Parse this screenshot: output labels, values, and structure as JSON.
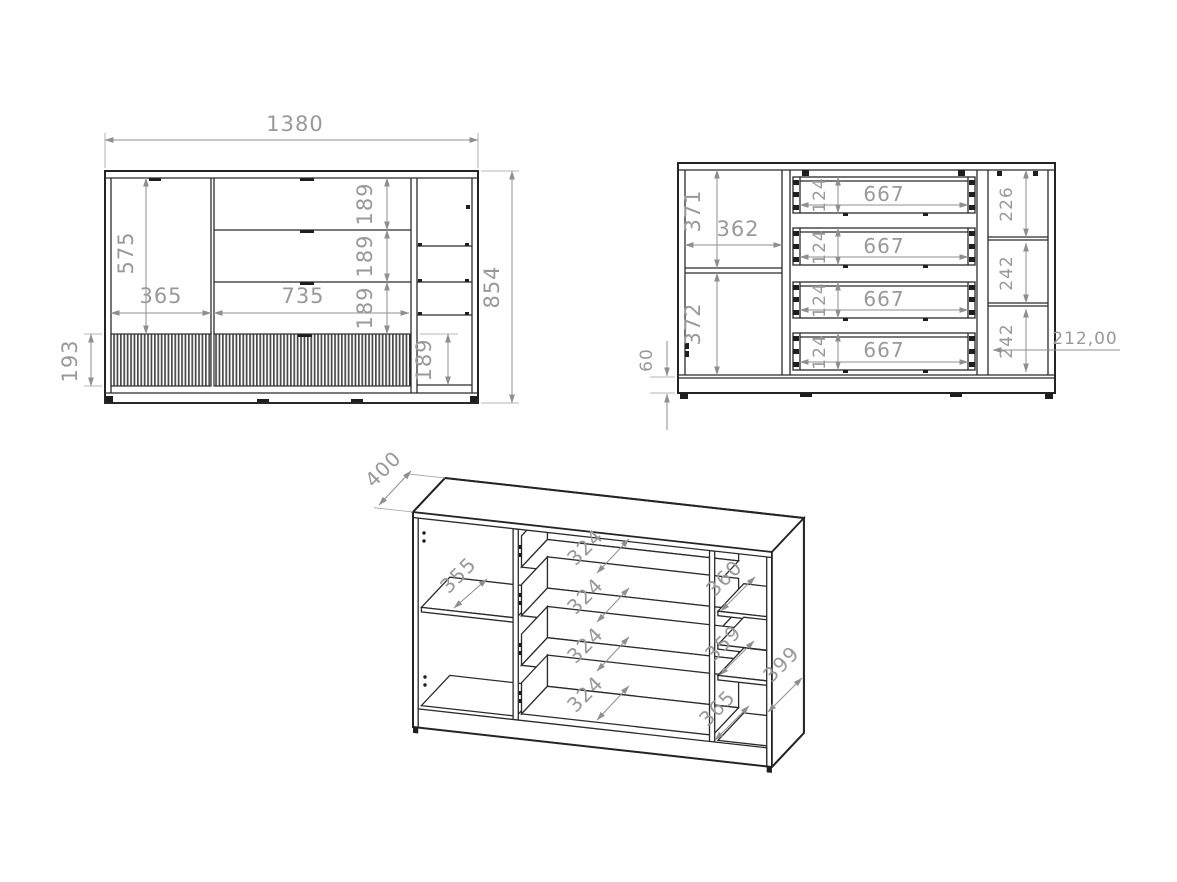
{
  "colors": {
    "outline": "#2b2b2b",
    "dimension_line": "#8f8f8f",
    "dimension_text": "#999999",
    "background": "#ffffff"
  },
  "front": {
    "width": "1380",
    "height": "854",
    "door_height": "575",
    "door_width": "365",
    "drawer_width": "735",
    "drawer_h1": "189",
    "drawer_h2": "189",
    "drawer_h3": "189",
    "niche_height": "189",
    "plinth_height": "193"
  },
  "internal": {
    "upper_height": "371",
    "inner_width": "362",
    "lower_height": "372",
    "base_height": "60",
    "drawer1": {
      "w": "667",
      "h": "124"
    },
    "drawer2": {
      "w": "667",
      "h": "124"
    },
    "drawer3": {
      "w": "667",
      "h": "124"
    },
    "drawer4": {
      "w": "667",
      "h": "124"
    },
    "right_top": "226",
    "right_mid": "242",
    "right_bottom": "242",
    "depth_note": "212,00"
  },
  "perspective": {
    "depth": "400",
    "shelf_left": "355",
    "drawer1": "324",
    "drawer2": "324",
    "drawer3": "324",
    "drawer4": "324",
    "shelf_r1": "360",
    "shelf_r2": "359",
    "shelf_r3": "365",
    "side_depth": "399"
  }
}
